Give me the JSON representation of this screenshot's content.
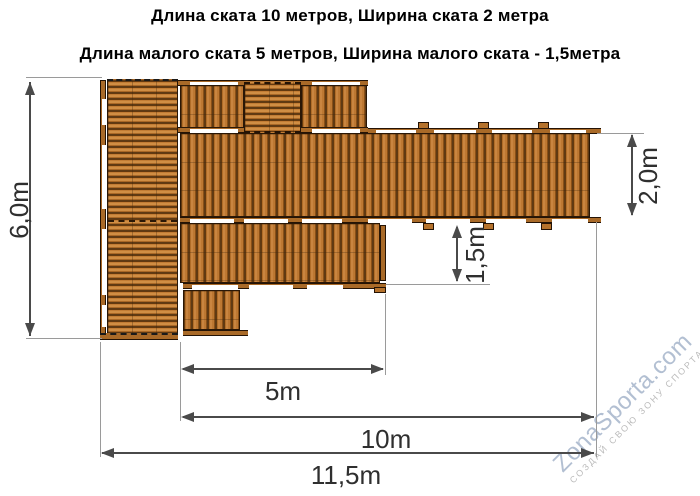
{
  "title": {
    "line1": "Длина ската 10 метров, Ширина ската 2 метра",
    "line2": "Длина малого ската 5 метров, Ширина малого ската - 1,5метра"
  },
  "dims": {
    "total_height": "6,0m",
    "main_width": "2,0m",
    "small_width": "1,5m",
    "small_length": "5m",
    "main_length": "10m",
    "total_length": "11,5m"
  },
  "watermark": {
    "brand": "ZonaSporta.com",
    "slogan": "СОЗДАЙ СВОЮ ЗОНУ СПОРТА"
  },
  "colors": {
    "wood_base": "#bd7832",
    "wood_dark": "#5e3a14",
    "wood_rail": "#a96a28",
    "dim_line": "#4a4a4a",
    "dim_text": "#2f2f2f",
    "ext_line": "#9a9a9a",
    "watermark_brand": "#b2bfd2",
    "watermark_slogan": "#bcbcbc"
  }
}
